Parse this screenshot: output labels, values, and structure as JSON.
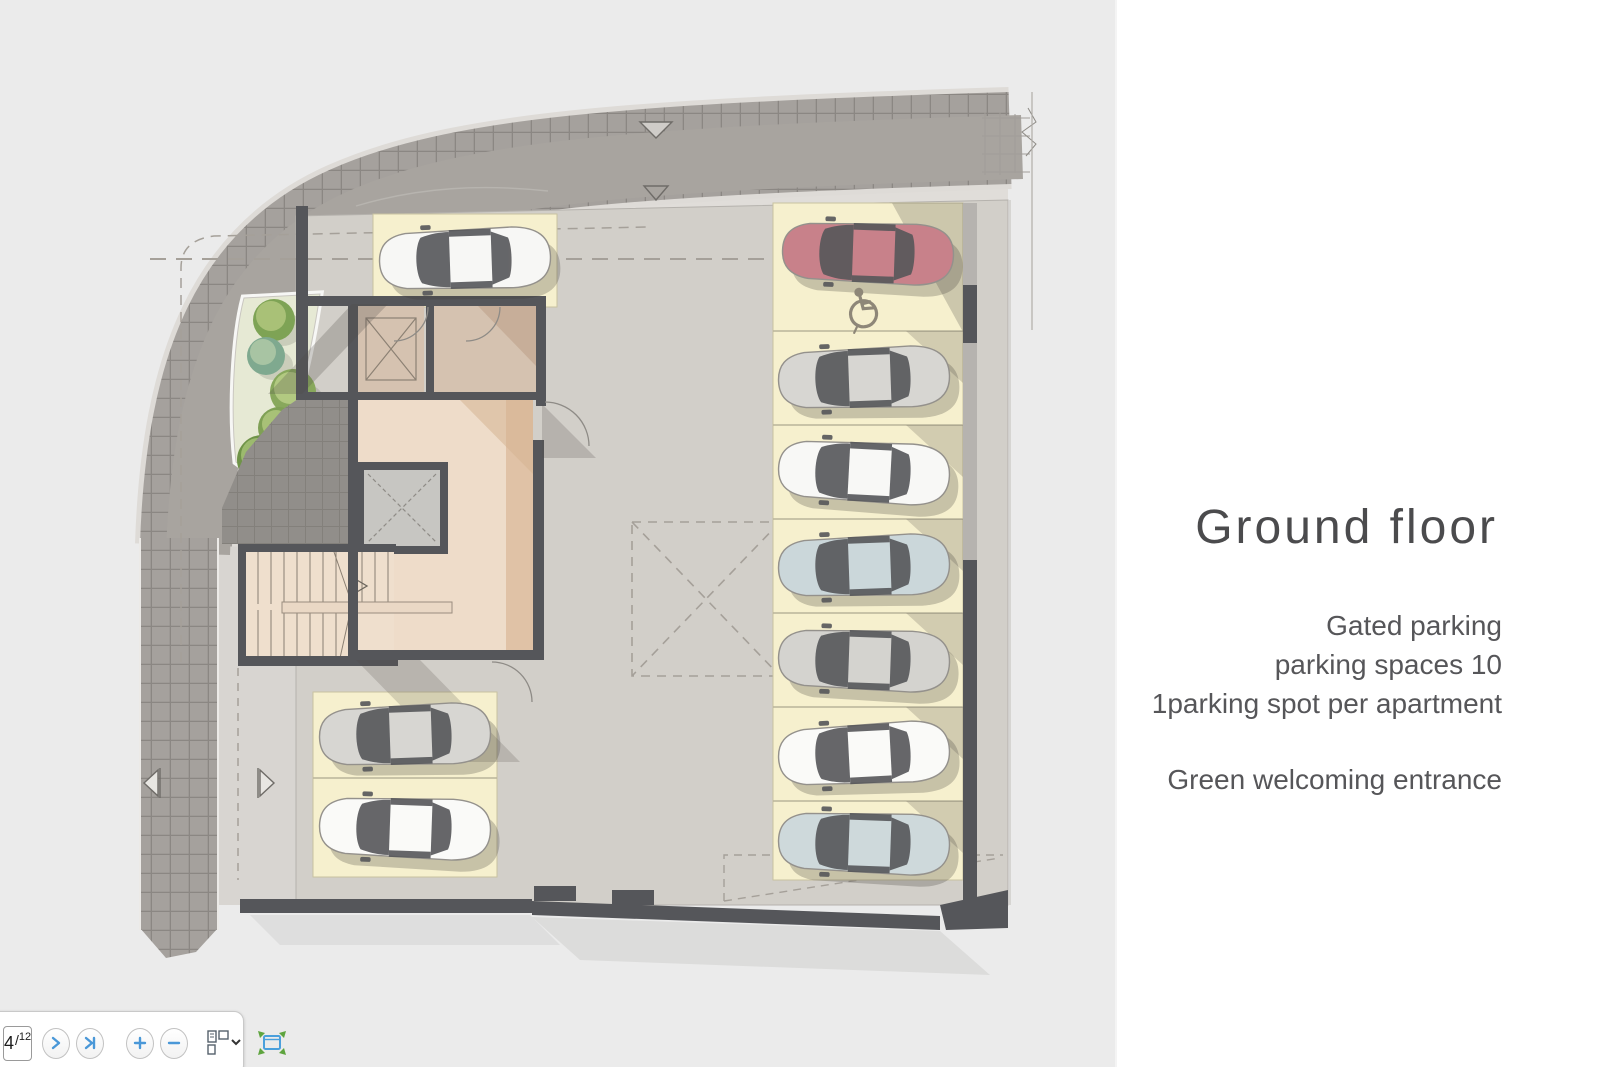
{
  "panel": {
    "title": "Ground floor",
    "notes": [
      "Gated parking",
      "parking spaces 10",
      "1parking spot per apartment"
    ],
    "note_entrance": "Green welcoming entrance"
  },
  "toolbar": {
    "page_current": "4",
    "page_divider": "/",
    "page_total": "12",
    "icons": {
      "next": "next-page-icon",
      "last": "last-page-icon",
      "zoom_in": "zoom-in-icon",
      "zoom_out": "zoom-out-icon",
      "page_layout": "page-layout-icon",
      "layout_dropdown": "chevron-down-icon",
      "fit_page": "fit-page-icon"
    }
  },
  "plan": {
    "label": "ground-floor-parking-plan",
    "parking": {
      "spaces": 10,
      "accessible_spaces": 1
    },
    "colors": {
      "background": "#ebebeb",
      "road": "#a8a49f",
      "sidewalk_tile": "#a5a19d",
      "floor": "#d2cfc9",
      "walls": "#55565a",
      "lobby_beige": "#eedcc9",
      "room_tan": "#d5c2b0",
      "parking_spot_yellow": "#f6f0ce",
      "tree_green": "#88a85c",
      "teal_accent": "#2ea39a",
      "accessible_car_red": "#c8818a"
    },
    "cars": [
      {
        "name": "car-accessible-spot",
        "color": "#c8818a"
      },
      {
        "name": "car-right-2",
        "color": "#d7d6d2"
      },
      {
        "name": "car-right-3",
        "color": "#f8f8f6"
      },
      {
        "name": "car-right-4",
        "color": "#cbd7da"
      },
      {
        "name": "car-right-5",
        "color": "#d4d3cf"
      },
      {
        "name": "car-right-6",
        "color": "#fafaf8"
      },
      {
        "name": "car-right-7",
        "color": "#ced9db"
      },
      {
        "name": "car-top-left",
        "color": "#f7f7f5"
      },
      {
        "name": "car-bottom-left-1",
        "color": "#d7d6d2"
      },
      {
        "name": "car-bottom-left-2",
        "color": "#fafaf8"
      }
    ]
  }
}
